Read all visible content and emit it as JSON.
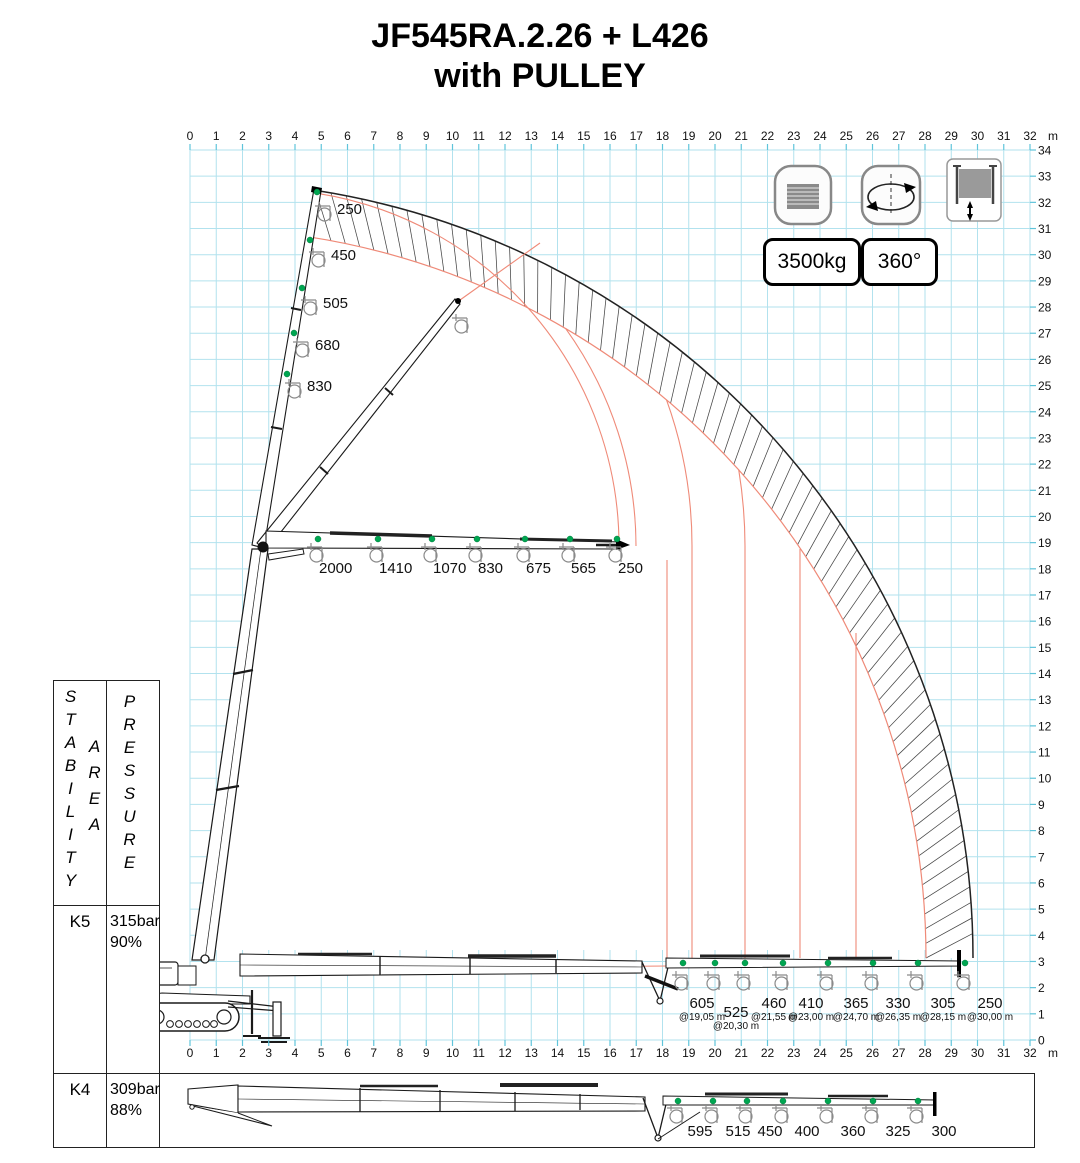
{
  "title": {
    "line1": "JF545RA.2.26 + L426",
    "line2": "with PULLEY"
  },
  "badges": {
    "capacity": "3500kg",
    "slewing": "360°"
  },
  "icons": [
    {
      "name": "stabilizer-plates-icon"
    },
    {
      "name": "slewing-rotation-icon"
    },
    {
      "name": "winch-icon"
    }
  ],
  "side_table": {
    "col1_header": "STABILITY",
    "col1_header_b": "AREA",
    "col2_header": "PRESSURE",
    "rows": [
      {
        "klass": "K5",
        "bar": "315bar",
        "pct": "90%"
      },
      {
        "klass": "K4",
        "bar": "309bar",
        "pct": "88%"
      }
    ]
  },
  "axes": {
    "x_unit": "m",
    "x_ticks": [
      0,
      1,
      2,
      3,
      4,
      5,
      6,
      7,
      8,
      9,
      10,
      11,
      12,
      13,
      14,
      15,
      16,
      17,
      18,
      19,
      20,
      21,
      22,
      23,
      24,
      25,
      26,
      27,
      28,
      29,
      30,
      31,
      32
    ],
    "y_ticks": [
      0,
      1,
      2,
      3,
      4,
      5,
      6,
      7,
      8,
      9,
      10,
      11,
      12,
      13,
      14,
      15,
      16,
      17,
      18,
      19,
      20,
      21,
      22,
      23,
      24,
      25,
      26,
      27,
      28,
      29,
      30,
      31,
      32,
      33,
      34
    ]
  },
  "chart_data": {
    "type": "diagram",
    "title": "JF545RA.2.26 + L426 with PULLEY crane working range diagram",
    "units": {
      "load": "kg",
      "distance": "m"
    },
    "x_range": [
      0,
      32
    ],
    "y_range": [
      0,
      34
    ],
    "max_capacity": "3500kg",
    "slewing": "360°",
    "jib_vertical_loads": [
      "250",
      "450",
      "505",
      "680",
      "830"
    ],
    "jib_horizontal_loads": [
      "2000",
      "1410",
      "1070",
      "830",
      "675",
      "565",
      "250"
    ],
    "ground_loads": [
      {
        "load": "605",
        "at": "@19,05 m"
      },
      {
        "load": "525",
        "at": "@20,30 m"
      },
      {
        "load": "460",
        "at": "@21,55 m"
      },
      {
        "load": "410",
        "at": "@23,00 m"
      },
      {
        "load": "365",
        "at": "@24,70 m"
      },
      {
        "load": "330",
        "at": "@26,35 m"
      },
      {
        "load": "305",
        "at": "@28,15 m"
      },
      {
        "load": "250",
        "at": "@30,00 m"
      }
    ],
    "k4_loads": [
      "595",
      "515",
      "450",
      "400",
      "360",
      "325",
      "300"
    ],
    "colors": {
      "grid": "#b2e2ee",
      "envelope_red": "#ef8a78",
      "dot_green": "#00a651"
    }
  }
}
